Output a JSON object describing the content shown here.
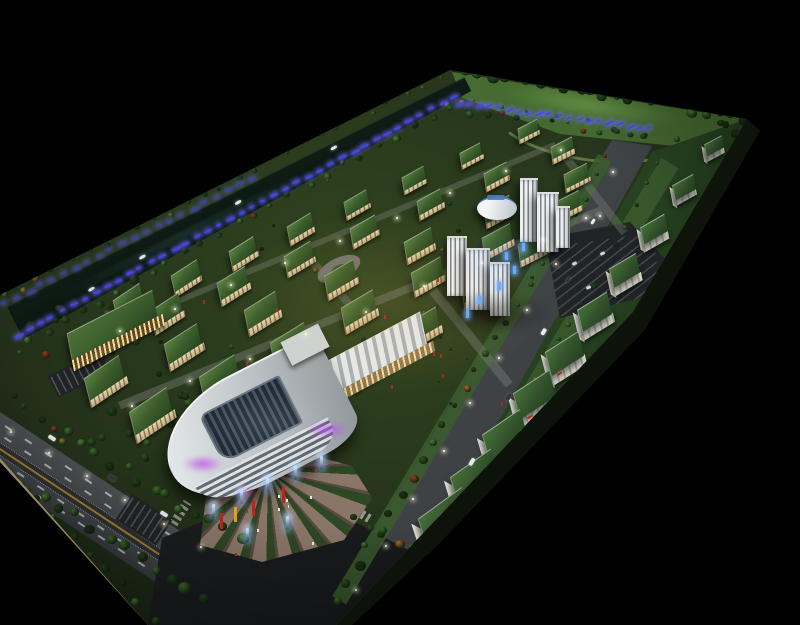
{
  "scene": {
    "title": "Architectural scale model photograph",
    "description": "Night-lit architectural scale model of a long rectangular industrial park viewed from a high oblique angle on a pure black background. A tree-lined river with glowing blue LED strips runs along the far edge, a grid of cream factory buildings with planted green roofs fills the center, a white office-tower cluster with a round podium stands mid-site, a curved white shopping mall with a glass atrium and purple accent lighting anchors the near end beside a fan-shaped plaza with glowing light poles and red banners, a wide avenue with dashed lanes runs along the near side fronted by a row of white green-roofed warehouses, and two boulevards meet at a large dark asphalt intersection.",
    "media_type": "photograph of physical model",
    "background": "black",
    "lighting": "miniature LEDs: warm windows, blue strips, purple mall accents"
  },
  "counts": {
    "factory_buildings": 35,
    "factory_rows": 5,
    "warehouses": 10,
    "office_towers": 6,
    "boats": 4,
    "plaza_light_poles": 7,
    "plaza_banners": 4,
    "cars_on_roads": 9,
    "roads": 2,
    "parking_lots": 3
  },
  "palette": {
    "background": "#000000",
    "base_green_light": "#31451f",
    "base_green": "#27361c",
    "base_green_dark": "#141d12",
    "lawn": "#4c7435",
    "lawn_light": "#6d9c4a",
    "water": "#0f1b15",
    "water_light": "#24423a",
    "tree_greens": [
      "#2e5223",
      "#3c6b2c",
      "#24421c",
      "#4a7d33",
      "#1d3315"
    ],
    "tree_accents": [
      "#9c3a20",
      "#b06a28",
      "#8a7c2a"
    ],
    "led_blue": "#4646ff",
    "led_glow": "rgba(110,110,255,0.9)",
    "roof_green_light": "#5b8140",
    "roof_green": "#3c5f2d",
    "roof_green_dark": "#2a451f",
    "facade_cream": "#e8d9ae",
    "facade_cream_dark": "#bfa97c",
    "window_warm": "#ffd98a",
    "white_wall": "#f2f1ea",
    "white_wall_dark": "#d2d1c5",
    "tower_light": "#eef0f1",
    "tower_dark": "#7a848d",
    "drum_sign_blue": "#4e79b8",
    "mall_roof_light": "#e8ecee",
    "mall_roof_dark": "#8f979c",
    "atrium": "#1f2a36",
    "purple_glow": "#ba50eb",
    "magenta_glow": "#e050c0",
    "plaza_paving": "#8a7668",
    "plaza_paving_dark": "#594a42",
    "plaza_bed": "#2e4724",
    "banner_red": "#c02418",
    "banner_yellow": "#e0a020",
    "asphalt": "#43474a",
    "asphalt_dark": "#17191b",
    "lane_white": "rgba(255,255,255,0.55)",
    "parking": "#212426",
    "median": "#2c2f31",
    "median_yellow": "#c09030",
    "verge_green": "#3b5c2e",
    "warehouse_strip": "#33552a",
    "curb_tan": "#b8a878",
    "rim_gray": "rgba(160,165,155,0.55)",
    "pole_glow": "#bfe0ff",
    "boat_white": "#dfe6e6",
    "car_white": "#e8eaea",
    "car_dark": "#30363a"
  }
}
